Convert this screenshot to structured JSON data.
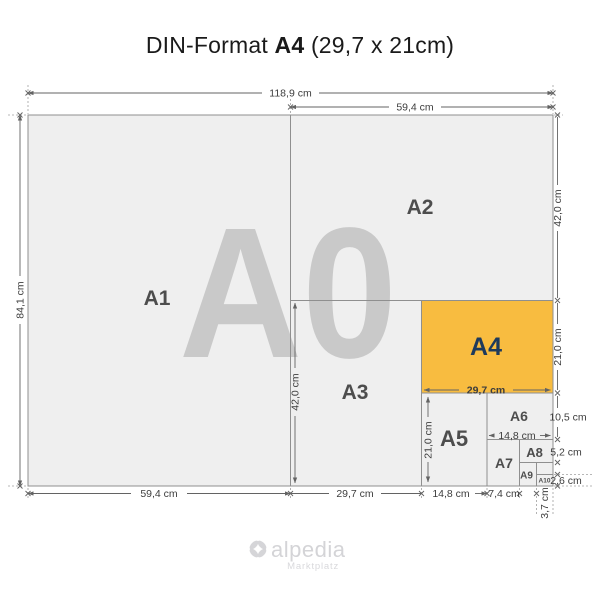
{
  "title": {
    "prefix": "DIN-Format",
    "format": "A4",
    "size": "(29,7 x 21cm)"
  },
  "labels": {
    "a0": "A0",
    "a1": "A1",
    "a2": "A2",
    "a3": "A3",
    "a4": "A4",
    "a5": "A5",
    "a6": "A6",
    "a7": "A7",
    "a8": "A8",
    "a9": "A9",
    "a10": "A10"
  },
  "dims": {
    "a0_width": "118,9 cm",
    "a2_width": "59,4 cm",
    "a0_height": "84,1 cm",
    "a2_height": "42,0 cm",
    "a4_height": "21,0 cm",
    "a6_height": "10,5 cm",
    "a8_height": "5,2 cm",
    "a10_height": "2,6 cm",
    "a3_height": "42,0 cm",
    "a4_width": "29,7 cm",
    "a5_height": "21,0 cm",
    "a6_width": "14,8 cm",
    "a1_width": "59,4 cm",
    "a3_width": "29,7 cm",
    "a5_width": "14,8 cm",
    "a7_width": "7,4 cm",
    "a9_width": "3,7 cm"
  },
  "colors": {
    "paper": "#EFEFEF",
    "a4_fill": "#F8BC40",
    "a4_text": "#1E3A5C",
    "watermark": "#C9C9C9",
    "border": "#8F8F8F"
  },
  "logo": {
    "name": "alpedia",
    "tagline": "Marktplatz"
  }
}
